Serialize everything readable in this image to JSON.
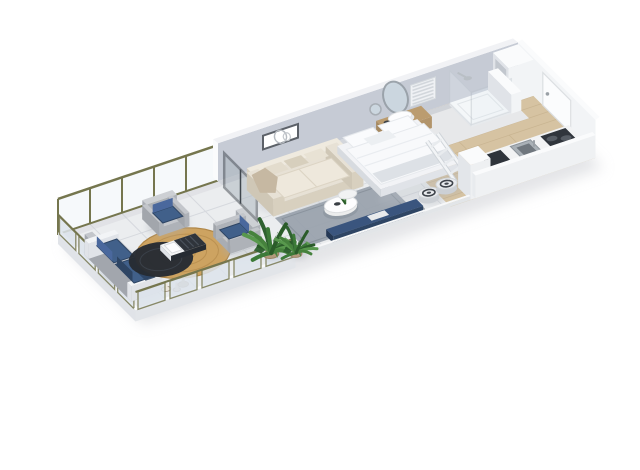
{
  "image": {
    "alt": "3D isometric floor plan of a studio apartment with terrace",
    "background": "#ffffff"
  },
  "rooms": [
    {
      "name": "terrace"
    },
    {
      "name": "living-room"
    },
    {
      "name": "sleeping-area"
    },
    {
      "name": "bathroom"
    },
    {
      "name": "kitchen"
    },
    {
      "name": "entry-hall"
    }
  ],
  "furniture": [
    "window-wall",
    "glass-balustrade",
    "outdoor-sofa",
    "outdoor-armchair",
    "round-jute-rug",
    "dark-round-rug",
    "outdoor-low-table",
    "decorative-vases",
    "monstera-plant",
    "sliding-glass-door",
    "indoor-sofa",
    "throw-blanket",
    "coffee-table",
    "nesting-table",
    "area-rug",
    "tv-bench",
    "robot-vacuum",
    "wall-art",
    "bed",
    "pillows",
    "duvet",
    "ladder",
    "pouf",
    "vanity",
    "washbasin",
    "oval-mirror",
    "round-mirror",
    "towel-radiator",
    "shower",
    "kitchen-counter",
    "cooktop",
    "sink",
    "entry-door",
    "wardrobe-niche"
  ],
  "colors": {
    "background": "#ffffff",
    "shadow": "#c9cbd0",
    "slabEdge": "#e2e5e9",
    "tile": "#ebedef",
    "tileLine": "#d6d9de",
    "wallGray": "#c6cbd5",
    "wallGrayTop": "#f1f2f5",
    "wallWhite": "#f2f4f6",
    "wallFace": "#e9ebee",
    "wallTop": "#fafbfc",
    "wallEdge": "#e0e3e8",
    "olive": "#75764e",
    "frostGlass": "#dde4ec",
    "clearGlass": "#eef3f8",
    "wood": "#d6c3a2",
    "woodLine": "#c2ac88",
    "bathFloor": "#e8eaee",
    "rugGray": "#98a1ab",
    "rugJute": "#cda361",
    "rugJuteLine": "#b08748",
    "rugDark": "#262b33",
    "navy": "#41608a",
    "navyLight": "#4a689d",
    "navyDark": "#2e4564",
    "chairGray": "#c3c6cb",
    "chairGrayDark": "#aeb2b8",
    "cream": "#e7e1d5",
    "creamLight": "#efeadf",
    "creamShade": "#d8d0bf",
    "taupe": "#c6b8a2",
    "green": "#3c7a38",
    "greenDark": "#2b5c2a",
    "greenLight": "#58984d",
    "white": "#fdfdfe",
    "bedTop": "#f2f3f6",
    "bedFront": "#e0e3e8",
    "bedSide": "#d7dbe0",
    "pillow": "#fafbfd",
    "mirror": "#ccd7e0",
    "steel": "#aab1b7",
    "steelDark": "#70777e",
    "applianceDark": "#2f343b",
    "vanityTop": "#bb9c6f",
    "vanityFront": "#b2946a",
    "vanitySide": "#a5885f",
    "doorWhite": "#fbfcfd",
    "potClay": "#b39a7c"
  }
}
